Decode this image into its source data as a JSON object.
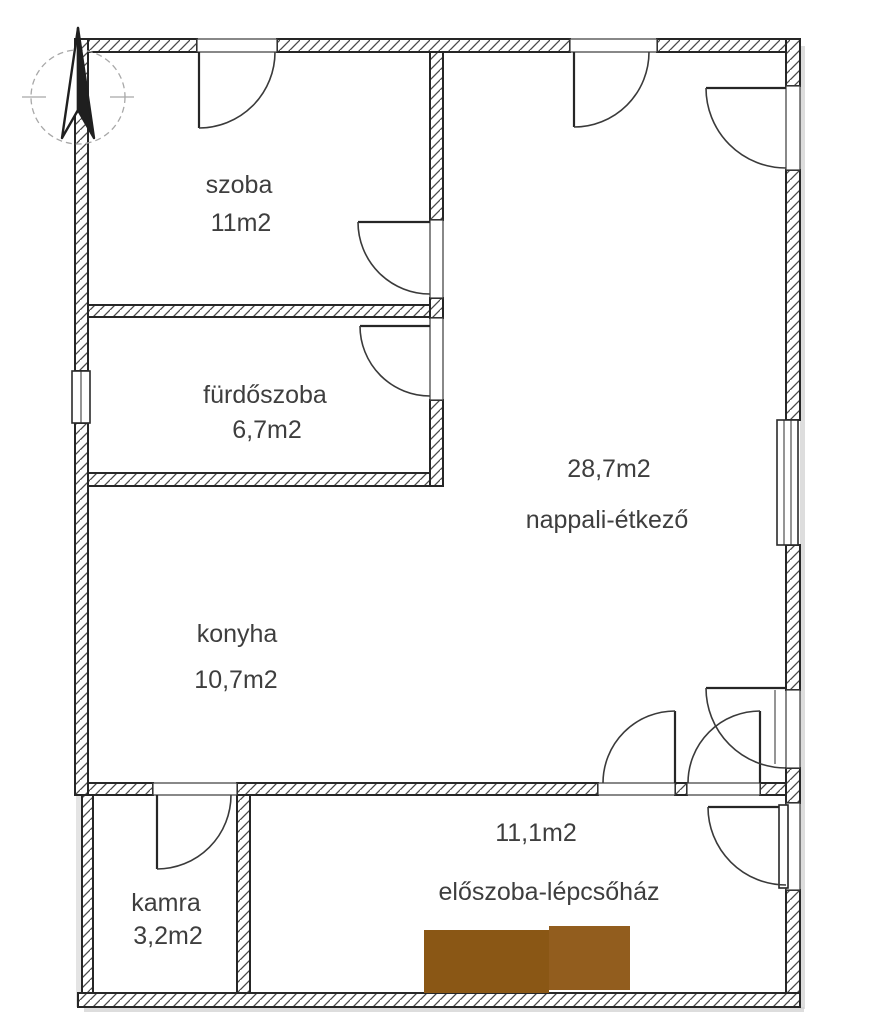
{
  "plan": {
    "type": "apartment-floor-plan",
    "rooms": [
      {
        "id": "szoba",
        "name": "szoba",
        "area": "11m2"
      },
      {
        "id": "furdoszoba",
        "name": "fürdőszoba",
        "area": "6,7m2"
      },
      {
        "id": "nappali",
        "name": "nappali-étkező",
        "area": "28,7m2"
      },
      {
        "id": "konyha",
        "name": "konyha",
        "area": "10,7m2"
      },
      {
        "id": "kamra",
        "name": "kamra",
        "area": "3,2m2"
      },
      {
        "id": "eloszoba",
        "name": "előszoba-lépcsőház",
        "area": "11,1m2"
      }
    ],
    "features": {
      "doors": 10,
      "windows": 2,
      "stairs_block": "brown rectangle in előszoba-lépcsőház",
      "compass": "north-arrow top-left"
    },
    "colors": {
      "wall_line": "#262626",
      "hatch_line": "#4a4a4a",
      "label_text": "#3e3e3e",
      "stairs_left": "#8a5715",
      "stairs_right": "#925d1e",
      "shadow": "#cfcfcf",
      "compass_line": "#a8a8a8",
      "arrow_fill": "#1f1f1f"
    }
  }
}
